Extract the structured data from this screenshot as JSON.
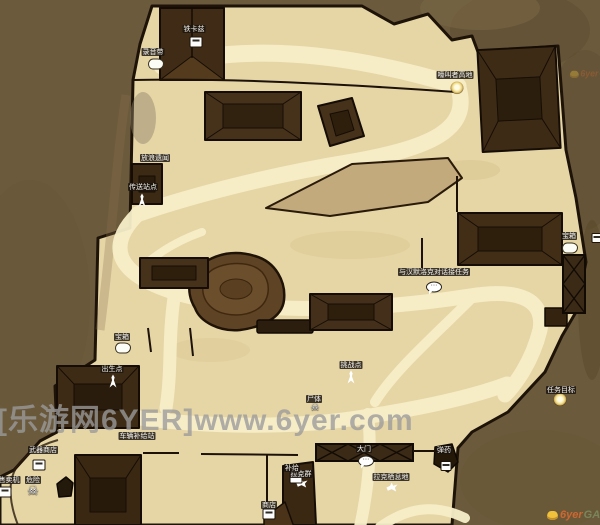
{
  "watermark": {
    "text": "[乐游网6YER]www.6yer.com"
  },
  "logo": {
    "site": "6yer",
    "suffix": "GAME"
  },
  "colors": {
    "background": "#6b5a3c",
    "land": "#e6d6a6",
    "road": "#f7efc9",
    "building": "#402c16",
    "plateau": "#c3aa7c",
    "watermark_gray": "#9b9b9b",
    "logo_orange": "#e06a30",
    "logo_green": "#7d8a5f"
  },
  "markers": [
    {
      "label": "铁卡兹",
      "lx": 194,
      "ly": 25,
      "icon": "vending",
      "ix": 196,
      "iy": 42
    },
    {
      "label": "录音带",
      "lx": 153,
      "ly": 48,
      "icon": "cloud",
      "ix": 156,
      "iy": 64
    },
    {
      "label": "放浪遗闻",
      "lx": 155,
      "ly": 154,
      "icon": "",
      "ix": 0,
      "iy": 0
    },
    {
      "label": "嚎叫者高地",
      "lx": 455,
      "ly": 71,
      "icon": "dot",
      "ix": 457,
      "iy": 88
    },
    {
      "label": "宝箱",
      "lx": 569,
      "ly": 232,
      "icon": "cloud",
      "ix": 570,
      "iy": 248
    },
    {
      "label": "与汉默洛克对话接任务",
      "lx": 434,
      "ly": 268,
      "icon": "speech",
      "ix": 434,
      "iy": 287
    },
    {
      "label": "挑战点",
      "lx": 351,
      "ly": 361,
      "icon": "person",
      "ix": 351,
      "iy": 377
    },
    {
      "label": "宝箱",
      "lx": 122,
      "ly": 333,
      "icon": "cloud",
      "ix": 123,
      "iy": 348
    },
    {
      "label": "传送站点",
      "lx": 143,
      "ly": 183,
      "icon": "person",
      "ix": 142,
      "iy": 200
    },
    {
      "label": "出生点",
      "lx": 112,
      "ly": 365,
      "icon": "person",
      "ix": 113,
      "iy": 381
    },
    {
      "label": "任务目标",
      "lx": 561,
      "ly": 386,
      "icon": "dot",
      "ix": 560,
      "iy": 400
    },
    {
      "label": "大门",
      "lx": 364,
      "ly": 445,
      "icon": "speech",
      "ix": 366,
      "iy": 461
    },
    {
      "label": "拉克群",
      "lx": 301,
      "ly": 470,
      "icon": "bird",
      "ix": 302,
      "iy": 483
    },
    {
      "label": "拉克栖息地",
      "lx": 391,
      "ly": 473,
      "icon": "bird",
      "ix": 392,
      "iy": 487
    },
    {
      "label": "车辆补给站",
      "lx": 137,
      "ly": 432,
      "icon": "",
      "ix": 0,
      "iy": 0
    },
    {
      "label": "武器商店",
      "lx": 43,
      "ly": 446,
      "icon": "vending",
      "ix": 39,
      "iy": 465
    },
    {
      "label": "售卖机",
      "lx": 9,
      "ly": 476,
      "icon": "vending",
      "ix": 5,
      "iy": 492
    },
    {
      "label": "危险",
      "lx": 33,
      "ly": 476,
      "icon": "skull",
      "ix": 33,
      "iy": 491
    },
    {
      "label": "商店",
      "lx": 269,
      "ly": 501,
      "icon": "vending",
      "ix": 269,
      "iy": 514
    },
    {
      "label": "弹药",
      "lx": 444,
      "ly": 446,
      "icon": "box",
      "ix": 446,
      "iy": 466
    },
    {
      "label": "尸体",
      "lx": 314,
      "ly": 395,
      "icon": "skull-small",
      "ix": 315,
      "iy": 408
    },
    {
      "label": "补给",
      "lx": 292,
      "ly": 464,
      "icon": "vending",
      "ix": 296,
      "iy": 478
    },
    {
      "label": "",
      "lx": 0,
      "ly": 0,
      "icon": "box",
      "ix": 597,
      "iy": 238
    }
  ]
}
